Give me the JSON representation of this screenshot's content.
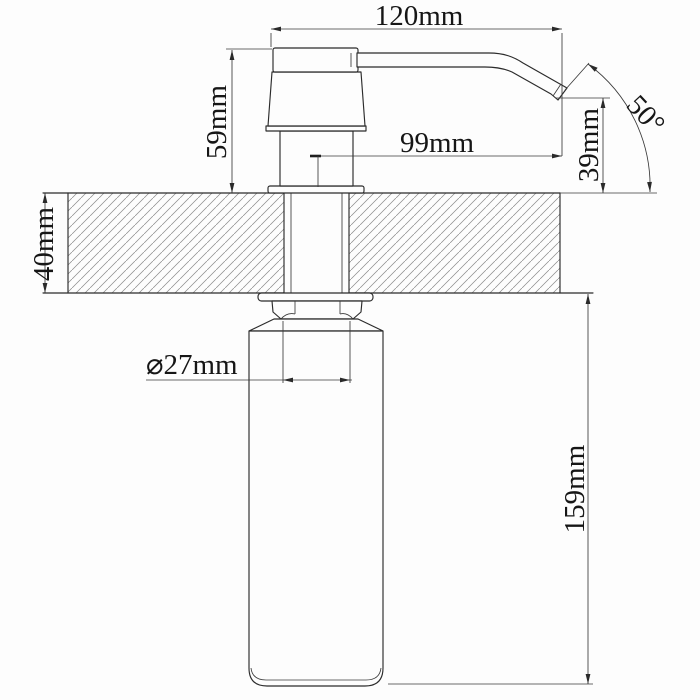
{
  "drawing": {
    "subject": "Deck-mounted kitchen soap dispenser - side section dimension drawing",
    "units": "mm",
    "dimensions": {
      "overall_reach": "120mm",
      "pump_height": "59mm",
      "spout_reach": "99mm",
      "outlet_height": "39mm",
      "outlet_angle": "50°",
      "counter_thickness": "40mm",
      "neck_diameter": "⌀27mm",
      "bottle_depth": "159mm"
    },
    "colors": {
      "line": "#2b2b2b",
      "hatch": "#8c8c8c",
      "background": "#fdfdfd"
    }
  }
}
